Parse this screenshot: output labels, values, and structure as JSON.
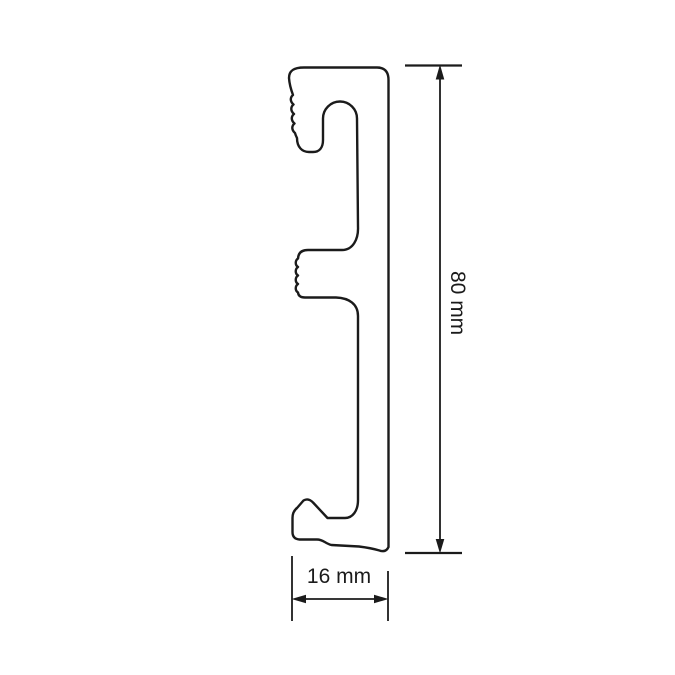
{
  "diagram": {
    "background_color": "#ffffff",
    "line_color": "#1b1b1b",
    "dimensions": {
      "height": {
        "label": "80 mm"
      },
      "width": {
        "label": "16 mm"
      }
    }
  }
}
